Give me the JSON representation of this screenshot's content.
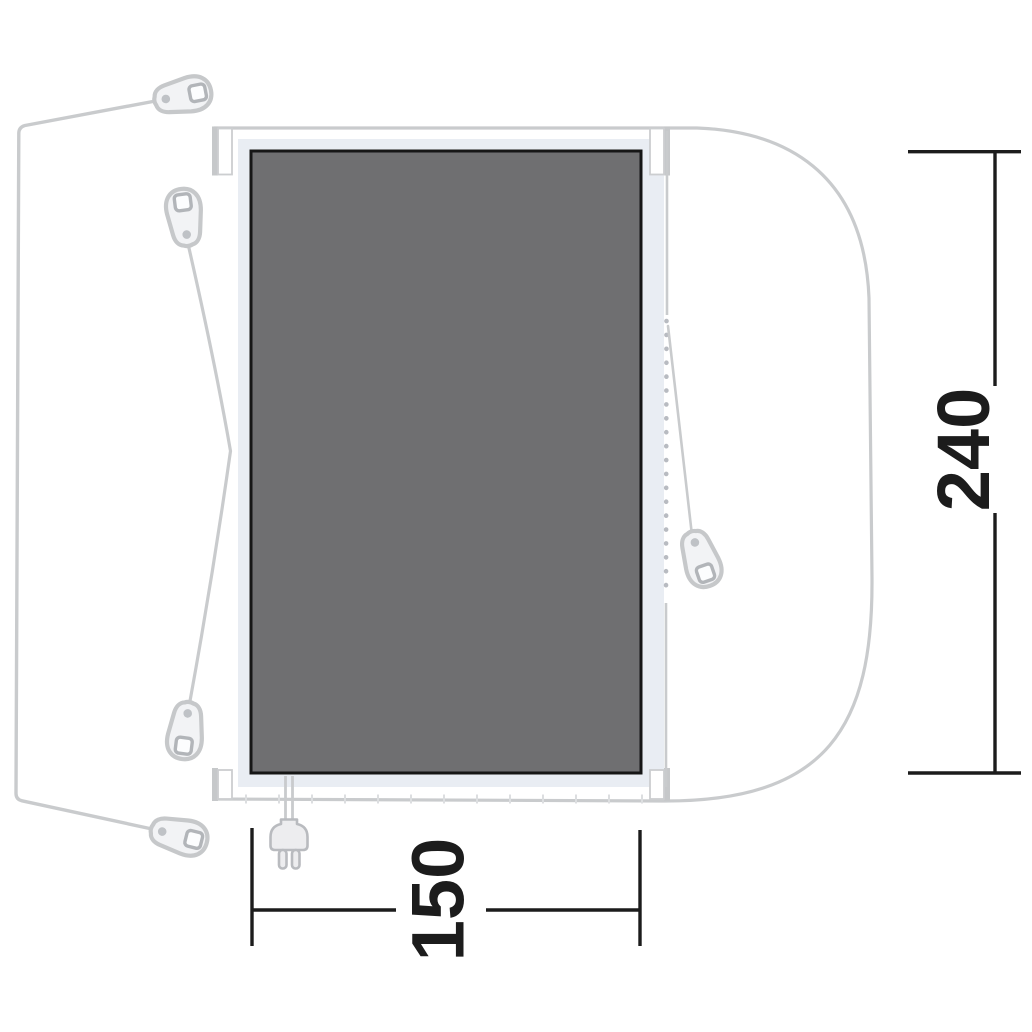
{
  "diagram": {
    "dimension_depth": {
      "label": "240"
    },
    "dimension_width": {
      "label": "150"
    },
    "colors": {
      "background": "#ffffff",
      "floor_fill": "#6f6f71",
      "floor_border": "#161616",
      "band_fill": "#e9edf3",
      "outline_stroke": "#c9cbcd",
      "zipper_dot_stroke": "#b8bbc1",
      "dimension_stroke": "#1c1c1c",
      "icon_fill": "#f2f3f5",
      "icon_stroke": "#c6c8ca"
    },
    "icons": {
      "peg": "peg-icon",
      "zipper_pull": "zipper-pull-icon",
      "zipper": "zipper-dotted-line",
      "power_plug": "power-plug-icon"
    }
  }
}
